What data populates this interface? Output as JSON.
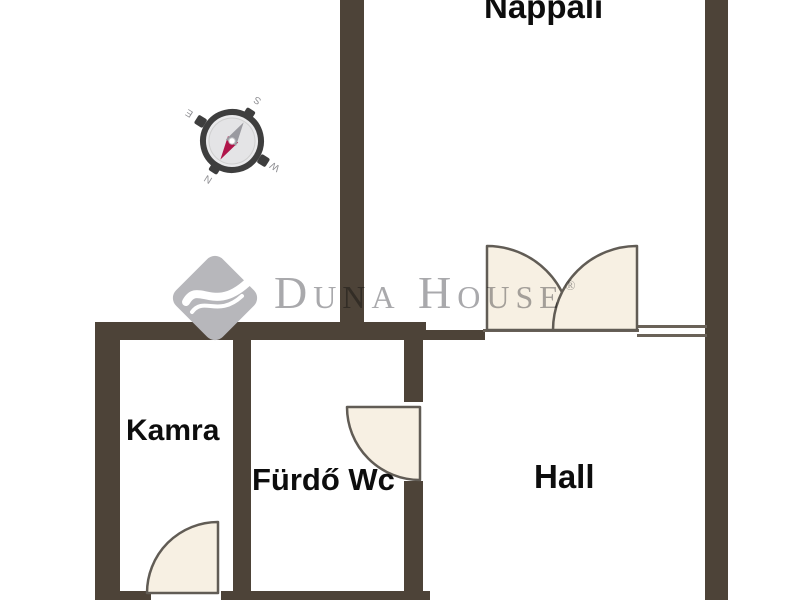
{
  "floorplan": {
    "rooms": [
      {
        "name": "Nappali"
      },
      {
        "name": "Kamra"
      },
      {
        "name": "Fürdő Wc"
      },
      {
        "name": "Hall"
      }
    ],
    "watermark": {
      "brand": "Duna House",
      "registered_mark": "®"
    },
    "compass": {
      "north": "N",
      "east": "E",
      "south": "S",
      "west": "W"
    },
    "colors": {
      "wall": "#4d4338",
      "door_fill": "#f7f0e3",
      "door_stroke": "#615c55",
      "label_text": "#0d0d0d",
      "watermark_gray": "#a9a9ac",
      "logo_diamond": "#b7b7bb",
      "compass_ring": "#3e3e3e",
      "compass_needle_north": "#b0154a",
      "compass_needle_south": "#9a9aa0",
      "background": "#ffffff"
    }
  }
}
